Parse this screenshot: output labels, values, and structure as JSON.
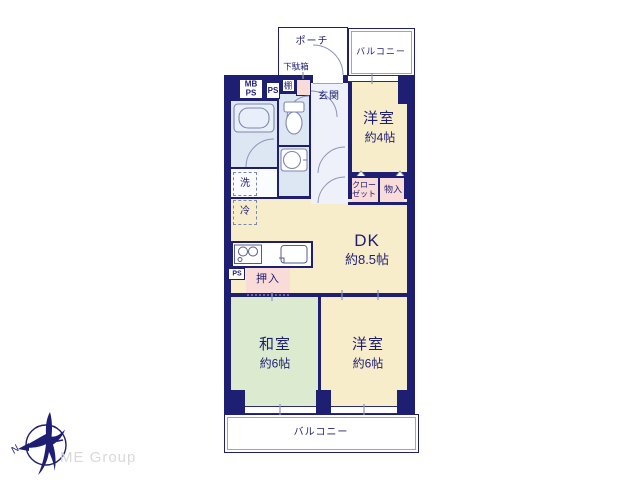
{
  "colors": {
    "wall_navy": "#1e1e73",
    "room_cream": "#f7edca",
    "room_green": "#dcebd0",
    "closet_pink": "#f9dbd8",
    "wet_blue": "#dde7f3",
    "hall_lavender": "#eef1f9",
    "line_gray": "#8b93b8",
    "logo_gray": "#d9d9d9"
  },
  "logo": {
    "company": "ME Group",
    "compass_north": "N"
  },
  "outdoor": {
    "porch": "ポーチ",
    "balcony_top": "バルコニー",
    "balcony_bottom": "バルコニー"
  },
  "labels": {
    "shoe_cabinet": "下駄箱",
    "shelf": "棚",
    "entrance": "玄関",
    "mb": "MB",
    "mb_ps": "PS",
    "ps_top": "PS",
    "ps_mid": "PS",
    "washer": "洗",
    "fridge": "冷",
    "oshiire": "押入",
    "closet_line1": "クロー",
    "closet_line2": "ゼット",
    "storage": "物入"
  },
  "rooms": {
    "west4": {
      "name": "洋室",
      "size": "約4帖"
    },
    "dk": {
      "name": "DK",
      "size": "約8.5帖"
    },
    "washitsu": {
      "name": "和室",
      "size": "約6帖"
    },
    "west6": {
      "name": "洋室",
      "size": "約6帖"
    }
  }
}
